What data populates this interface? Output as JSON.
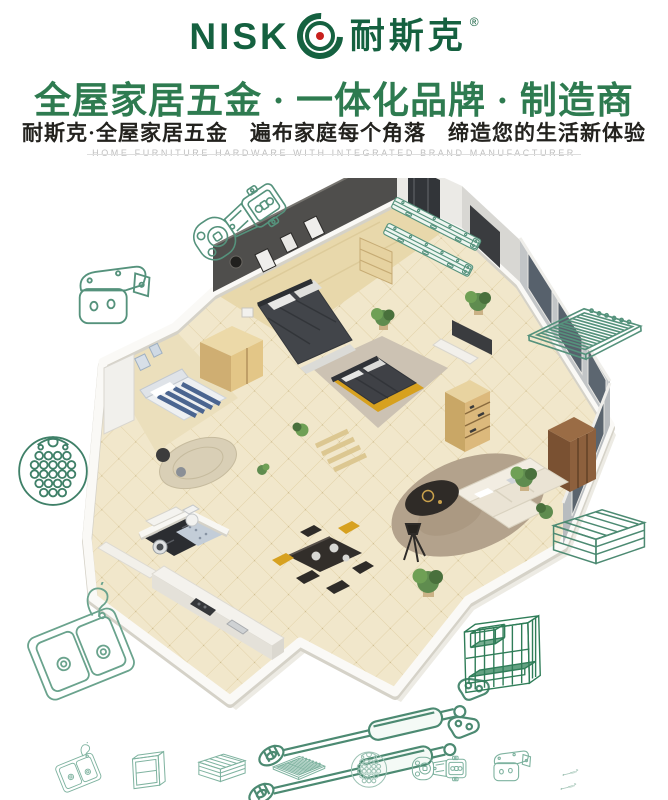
{
  "brand": {
    "logo_latin": "NISK",
    "logo_cn": "耐斯克",
    "registered": "®",
    "logo_color": "#156140",
    "dot_color": "#c8201d"
  },
  "headline": "全屋家居五金 · 一体化品牌 · 制造商",
  "subheadline": "耐斯克·全屋家居五金　遍布家庭每个角落　缔造您的生活新体验",
  "tagline_en": "HOME FURNITURE HARDWARE WITH INTEGRATED BRAND MANUFACTURER",
  "colors": {
    "headline_green": "#2e7b50",
    "text_dark": "#23221e",
    "tagline_gray": "#bfbfbf",
    "lineart_green": "#55927c",
    "lineart_dark_green": "#2f7d58"
  },
  "center_illustration": "apartment-3d-floorplan",
  "decorations": {
    "top_left": "cabinet-hinge",
    "top_right": "drawer-slides",
    "left_upper": "corner-bracket",
    "left_middle": "perforated-plate",
    "right_upper": "wire-shelf",
    "right_middle": "wire-basket",
    "bottom_left": "kitchen-sink",
    "bottom_center": "gas-struts",
    "bottom_right": "wire-organizer"
  },
  "bottom_icons": [
    "kitchen-sink",
    "cabinet-frame",
    "wire-basket",
    "wire-shelf",
    "perforated-plate",
    "cabinet-hinge",
    "corner-bracket",
    "gas-struts"
  ]
}
